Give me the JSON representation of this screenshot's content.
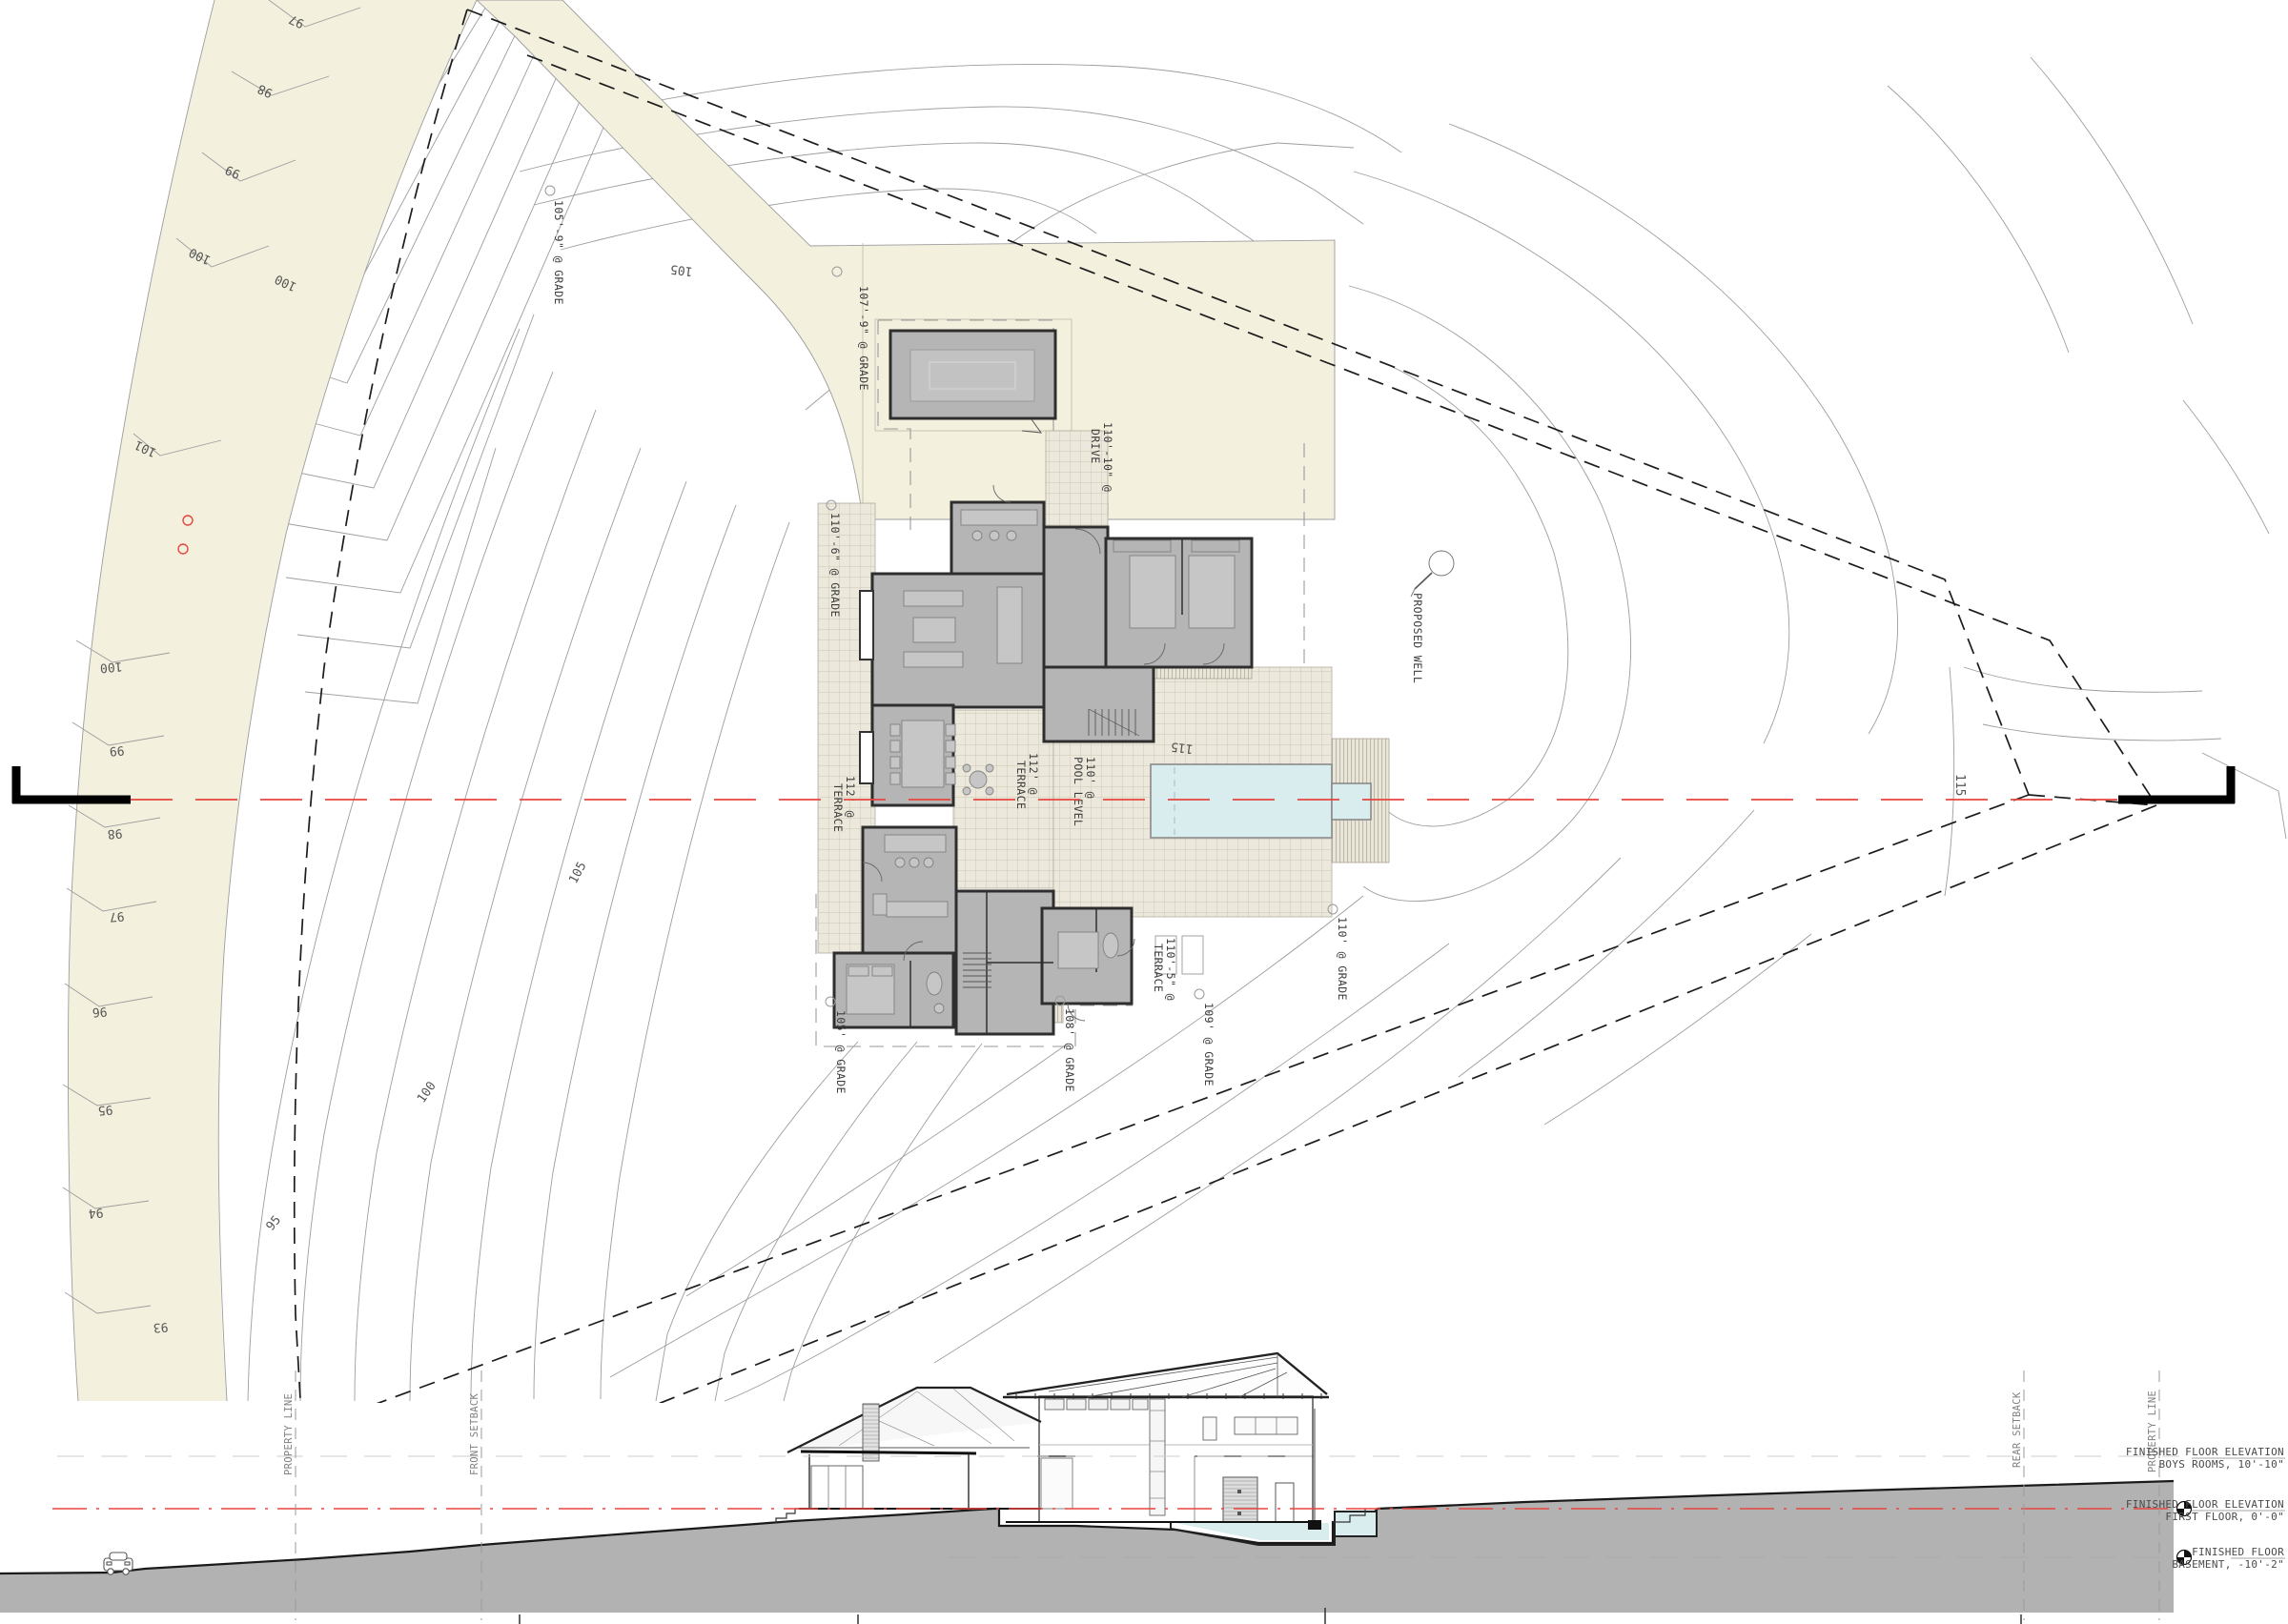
{
  "plan": {
    "road_contour_labels": [
      "97",
      "98",
      "99",
      "100",
      "101",
      "100",
      "99",
      "98",
      "97",
      "96",
      "95",
      "94",
      "93"
    ],
    "field_contour_labels": [
      "105",
      "100",
      "105",
      "100",
      "95",
      "115",
      "115"
    ],
    "grade_markers": [
      {
        "l1": "105'-9\" @ GRADE",
        "l2": ""
      },
      {
        "l1": "107'-9\" @ GRADE",
        "l2": ""
      },
      {
        "l1": "110'-10\" @",
        "l2": "DRIVE"
      },
      {
        "l1": "110'-6\" @ GRADE",
        "l2": ""
      },
      {
        "l1": "112' @",
        "l2": "TERRACE"
      },
      {
        "l1": "112' @",
        "l2": "TERRACE"
      },
      {
        "l1": "110' @",
        "l2": "POOL LEVEL"
      },
      {
        "l1": "110'-5\" @",
        "l2": "TERRACE"
      },
      {
        "l1": "105' @ GRADE",
        "l2": ""
      },
      {
        "l1": "108' @ GRADE",
        "l2": ""
      },
      {
        "l1": "109' @ GRADE",
        "l2": ""
      },
      {
        "l1": "110' @ GRADE",
        "l2": ""
      }
    ],
    "well_label": "PROPOSED WELL"
  },
  "section": {
    "ref_lines": [
      "PROPERTY LINE",
      "FRONT SETBACK",
      "REAR SETBACK",
      "PROPERTY LINE"
    ],
    "levels": [
      {
        "l1": "FINISHED FLOOR ELEVATION",
        "l2": "BOYS ROOMS, 10'-10\""
      },
      {
        "l1": "FINISHED FLOOR ELEVATION",
        "l2": "FIRST FLOOR, 0'-0\""
      },
      {
        "l1": "FINISHED FLOOR",
        "l2": "BASEMENT, -10'-2\""
      }
    ]
  },
  "colors": {
    "paving": "#f3f0de",
    "earth": "#b2b2b2",
    "pool": "#d9edef",
    "section_line": "#e8453f",
    "room_fill": "#b5b5b5"
  }
}
